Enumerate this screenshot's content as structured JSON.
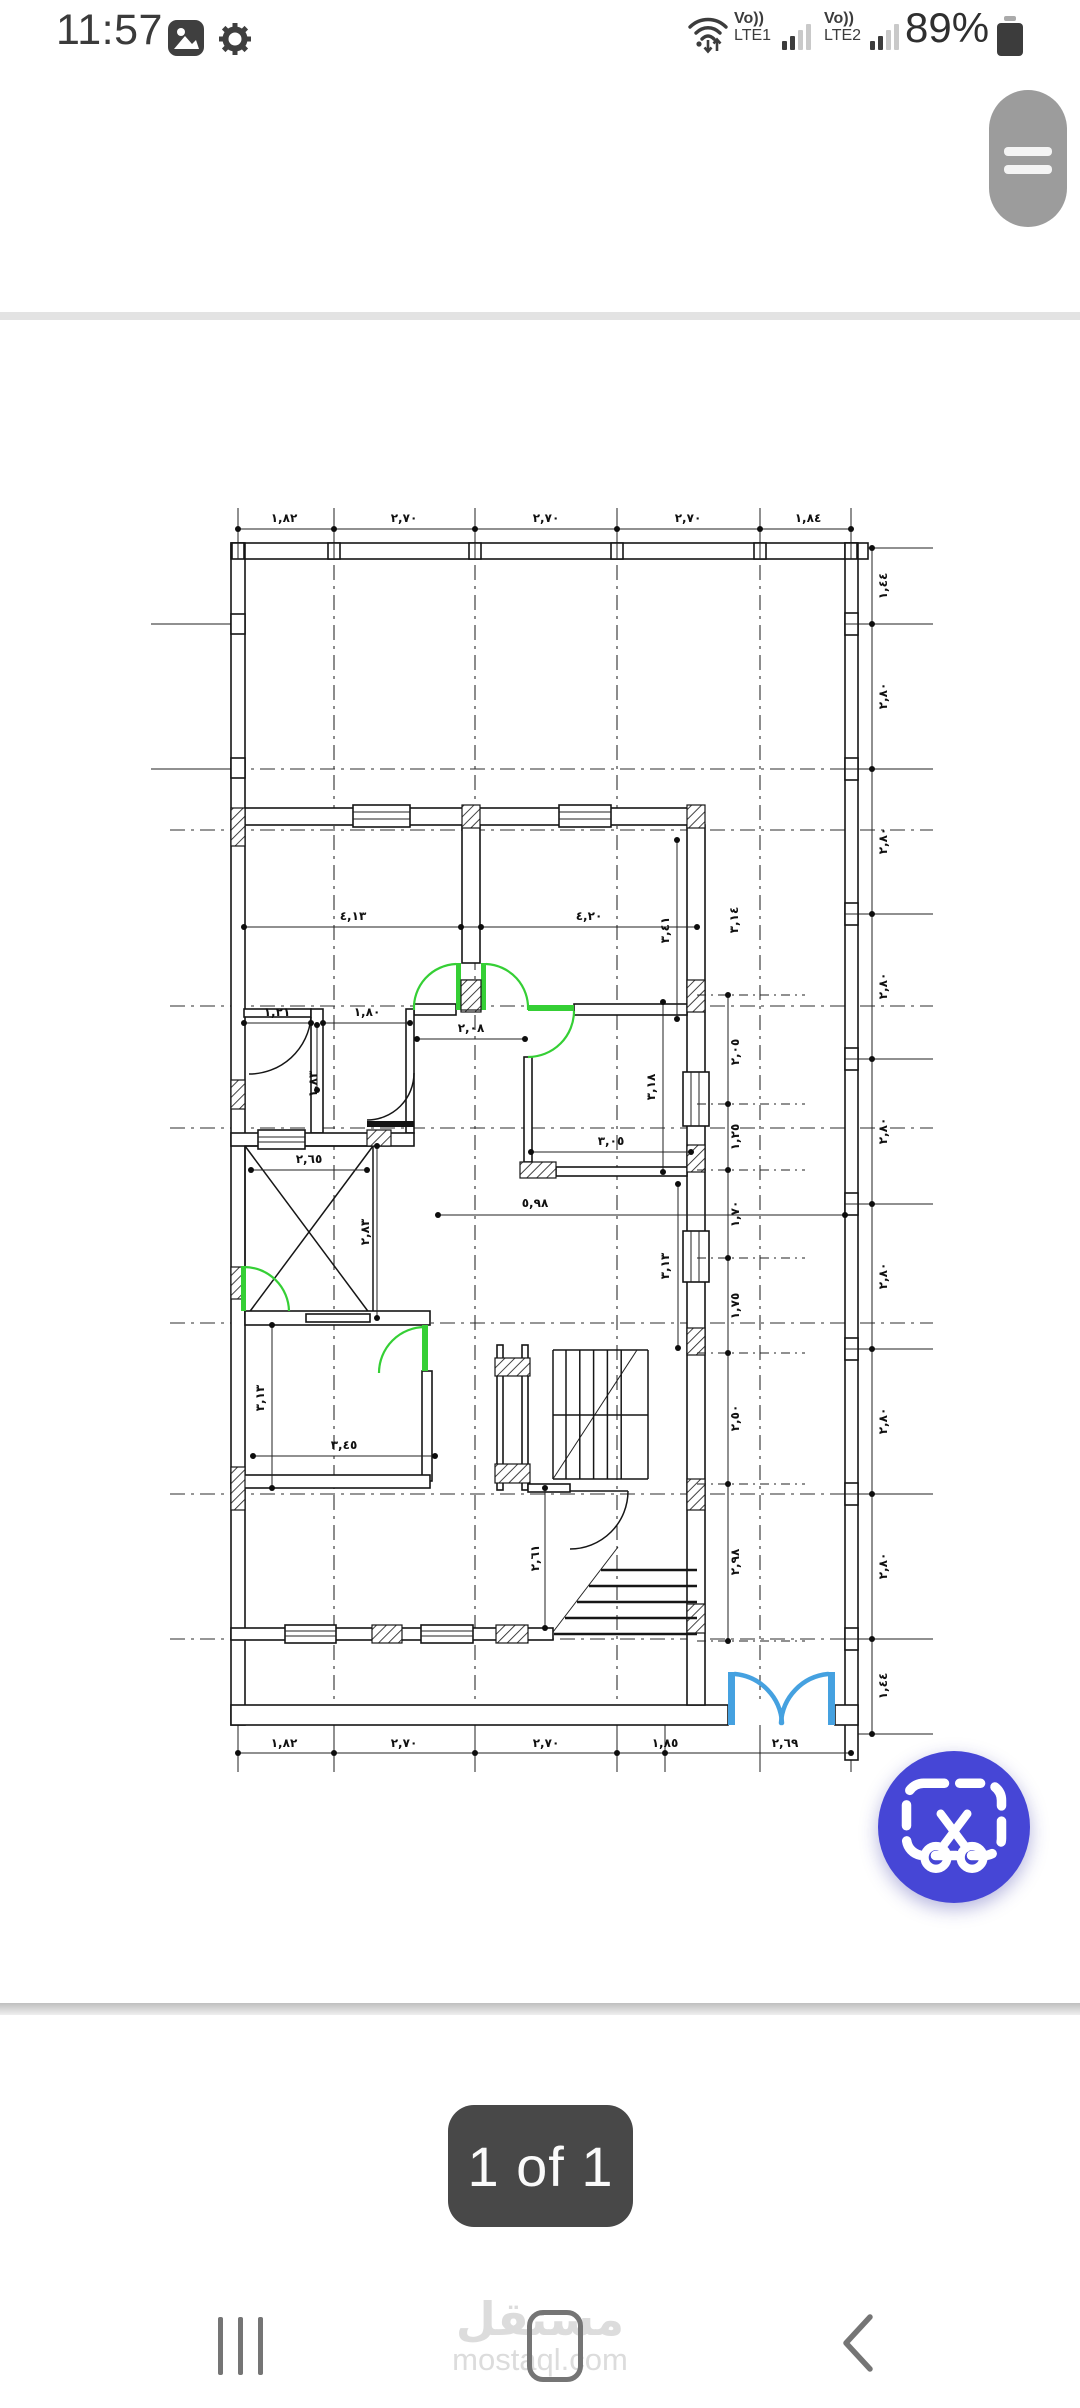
{
  "status_bar": {
    "time": "11:57",
    "carrier1": {
      "volte": "Vo))",
      "network": "LTE1"
    },
    "carrier2": {
      "volte": "Vo))",
      "network": "LTE2"
    },
    "battery_percent": "89%"
  },
  "viewer": {
    "page_indicator": "1 of 1"
  },
  "watermark": {
    "arabic": "مستقل",
    "latin": "mostaql.com"
  },
  "colors": {
    "fab_blue": "#4646d6",
    "door_green": "#35cf35",
    "entrance_door_blue": "#45a1e0",
    "menu_handle_gray": "#9c9c9c"
  },
  "plan": {
    "description": "architectural floor plan drawing",
    "dim_labels": [
      {
        "t": "١,٨٢",
        "x": 139,
        "y": 42
      },
      {
        "t": "٢,٧٠",
        "x": 259,
        "y": 42
      },
      {
        "t": "٢,٧٠",
        "x": 401,
        "y": 42
      },
      {
        "t": "٢,٧٠",
        "x": 543,
        "y": 42
      },
      {
        "t": "١,٨٤",
        "x": 663,
        "y": 42
      },
      {
        "t": "١,٨٢",
        "x": 139,
        "y": 1267
      },
      {
        "t": "٢,٧٠",
        "x": 259,
        "y": 1267
      },
      {
        "t": "٢,٧٠",
        "x": 401,
        "y": 1267
      },
      {
        "t": "١,٨٥",
        "x": 520,
        "y": 1267
      },
      {
        "t": "٢,٦٩",
        "x": 640,
        "y": 1267
      },
      {
        "t": "١,٤٤",
        "x": 742,
        "y": 106,
        "r": 1
      },
      {
        "t": "٢,٨٠",
        "x": 742,
        "y": 216,
        "r": 1
      },
      {
        "t": "٢,٨٠",
        "x": 742,
        "y": 361,
        "r": 1
      },
      {
        "t": "٢,٨٠",
        "x": 742,
        "y": 506,
        "r": 1
      },
      {
        "t": "٢,٨٠",
        "x": 742,
        "y": 651,
        "r": 1
      },
      {
        "t": "٢,٨٠",
        "x": 742,
        "y": 796,
        "r": 1
      },
      {
        "t": "٢,٨٠",
        "x": 742,
        "y": 941,
        "r": 1
      },
      {
        "t": "٢,٨٠",
        "x": 742,
        "y": 1086,
        "r": 1
      },
      {
        "t": "١,٤٤",
        "x": 742,
        "y": 1206,
        "r": 1
      },
      {
        "t": "٤,١٣",
        "x": 208,
        "y": 440
      },
      {
        "t": "٤,٢٠",
        "x": 444,
        "y": 440
      },
      {
        "t": "٣,٤١",
        "x": 524,
        "y": 450,
        "r": 1
      },
      {
        "t": "٣,١٤",
        "x": 593,
        "y": 440,
        "r": 1
      },
      {
        "t": "١,٢١",
        "x": 132,
        "y": 536
      },
      {
        "t": "١,٨٠",
        "x": 222,
        "y": 536
      },
      {
        "t": "٢,٠٨",
        "x": 326,
        "y": 552
      },
      {
        "t": "١,٨٣",
        "x": 172,
        "y": 604,
        "r": 1
      },
      {
        "t": "٢,٦٥",
        "x": 164,
        "y": 683
      },
      {
        "t": "٢,٨٣",
        "x": 224,
        "y": 752,
        "r": 1
      },
      {
        "t": "٣,١٨",
        "x": 510,
        "y": 607,
        "r": 1
      },
      {
        "t": "٣,٠٥",
        "x": 466,
        "y": 665
      },
      {
        "t": "٣,١٣",
        "x": 524,
        "y": 786,
        "r": 1
      },
      {
        "t": "٢,٠٥",
        "x": 594,
        "y": 572,
        "r": 1
      },
      {
        "t": "١,٢٥",
        "x": 594,
        "y": 657,
        "r": 1
      },
      {
        "t": "١,٧٠",
        "x": 594,
        "y": 734,
        "r": 1
      },
      {
        "t": "١,٧٥",
        "x": 594,
        "y": 826,
        "r": 1
      },
      {
        "t": "٢,٥٠",
        "x": 594,
        "y": 938,
        "r": 1
      },
      {
        "t": "٢,٩٨",
        "x": 594,
        "y": 1082,
        "r": 1
      },
      {
        "t": "٥,٩٨",
        "x": 390,
        "y": 727
      },
      {
        "t": "٣,١٣",
        "x": 119,
        "y": 918,
        "r": 1
      },
      {
        "t": "٣,٤٥",
        "x": 199,
        "y": 969
      },
      {
        "t": "٢,٦١",
        "x": 394,
        "y": 1078,
        "r": 1
      }
    ]
  }
}
